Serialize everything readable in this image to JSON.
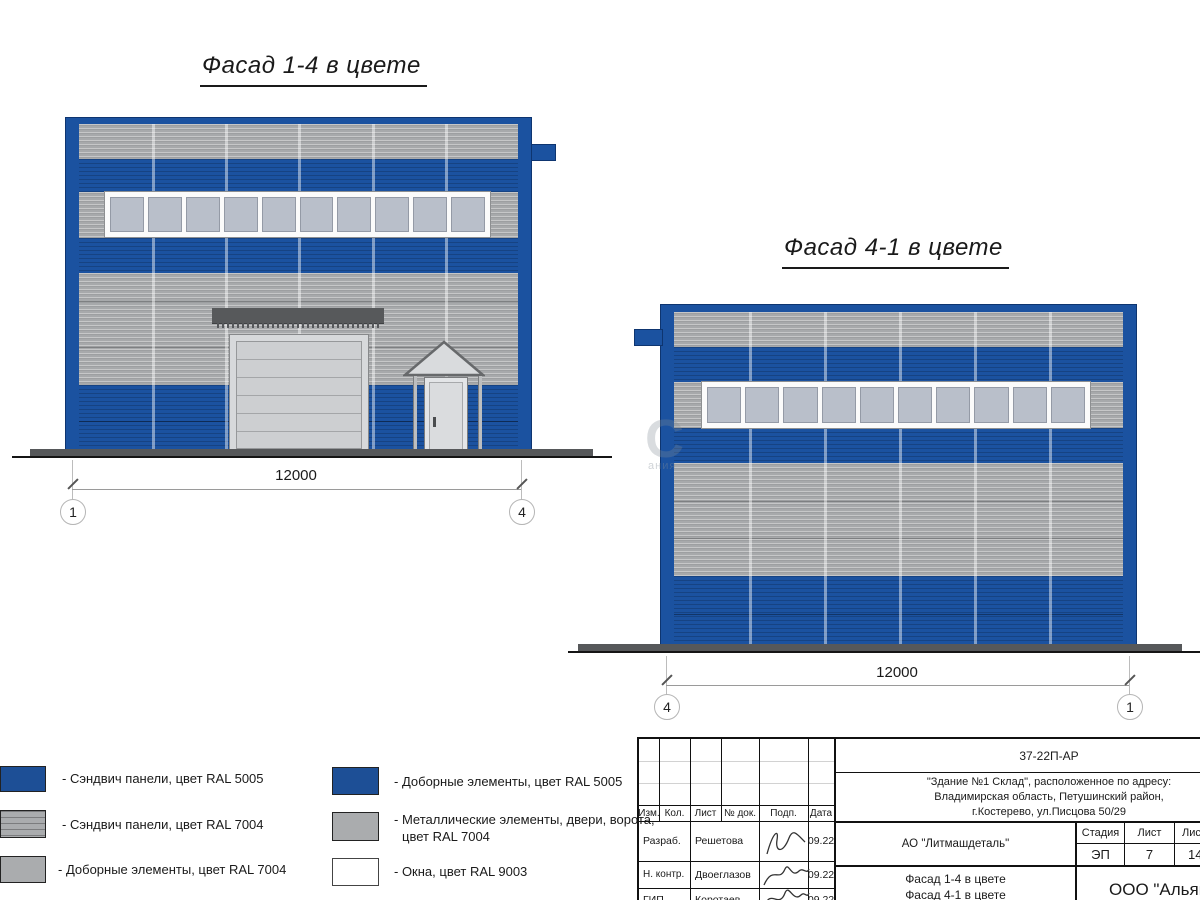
{
  "titles": {
    "facade14": "Фасад 1-4 в цвете",
    "facade41": "Фасад 4-1 в цвете"
  },
  "facade14": {
    "dimension": "12000",
    "axis_left": "1",
    "axis_right": "4",
    "pane_count": 10
  },
  "facade41": {
    "dimension": "12000",
    "axis_left": "4",
    "axis_right": "1",
    "pane_count": 10
  },
  "colors": {
    "ral5005_blue": "#1b52a0",
    "ral7004_gray": "#a7a9ab",
    "ral9003_white": "#ffffff",
    "window_pane": "#b9bfca",
    "ground": "#56585a"
  },
  "legend": {
    "items": [
      {
        "label": "- Сэндвич панели, цвет RAL 5005",
        "swatch": "blue"
      },
      {
        "label": "- Сэндвич панели, цвет RAL 7004",
        "swatch": "gray-striped"
      },
      {
        "label": "- Доборные элементы, цвет RAL 7004",
        "swatch": "gray"
      },
      {
        "label": "- Доборные элементы, цвет RAL 5005",
        "swatch": "blue"
      },
      {
        "label": "- Металлические элементы, двери, ворота,",
        "label2": "цвет RAL 7004",
        "swatch": "gray"
      },
      {
        "label": "- Окна, цвет RAL 9003",
        "swatch": "white"
      }
    ]
  },
  "watermark": {
    "big": "С",
    "small": "ания"
  },
  "titleblock": {
    "doc_code": "37-22П-АР",
    "address_line1": "\"Здание №1 Склад\", расположенное по адресу:",
    "address_line2": "Владимирская область, Петушинский район,",
    "address_line3": "г.Костерево, ул.Писцова 50/29",
    "columns": {
      "izm": "Изм.",
      "kol": "Кол.",
      "list": "Лист",
      "ndok": "№ док.",
      "podp": "Подп.",
      "data": "Дата"
    },
    "rows": [
      {
        "role": "Разраб.",
        "name": "Решетова",
        "date": "09.22"
      },
      {
        "role": "Н. контр.",
        "name": "Двоеглазов",
        "date": "09.22"
      },
      {
        "role": "ГИП",
        "name": "Коротаев",
        "date": "09.22"
      }
    ],
    "client": "АО \"Литмашдеталь\"",
    "stage_label": "Стадия",
    "sheet_label": "Лист",
    "sheets_label": "Листов",
    "stage": "ЭП",
    "sheet": "7",
    "sheets": "14",
    "subject_line1": "Фасад 1-4 в цвете",
    "subject_line2": "Фасад 4-1 в цвете",
    "company": "ООО \"Альянс"
  }
}
